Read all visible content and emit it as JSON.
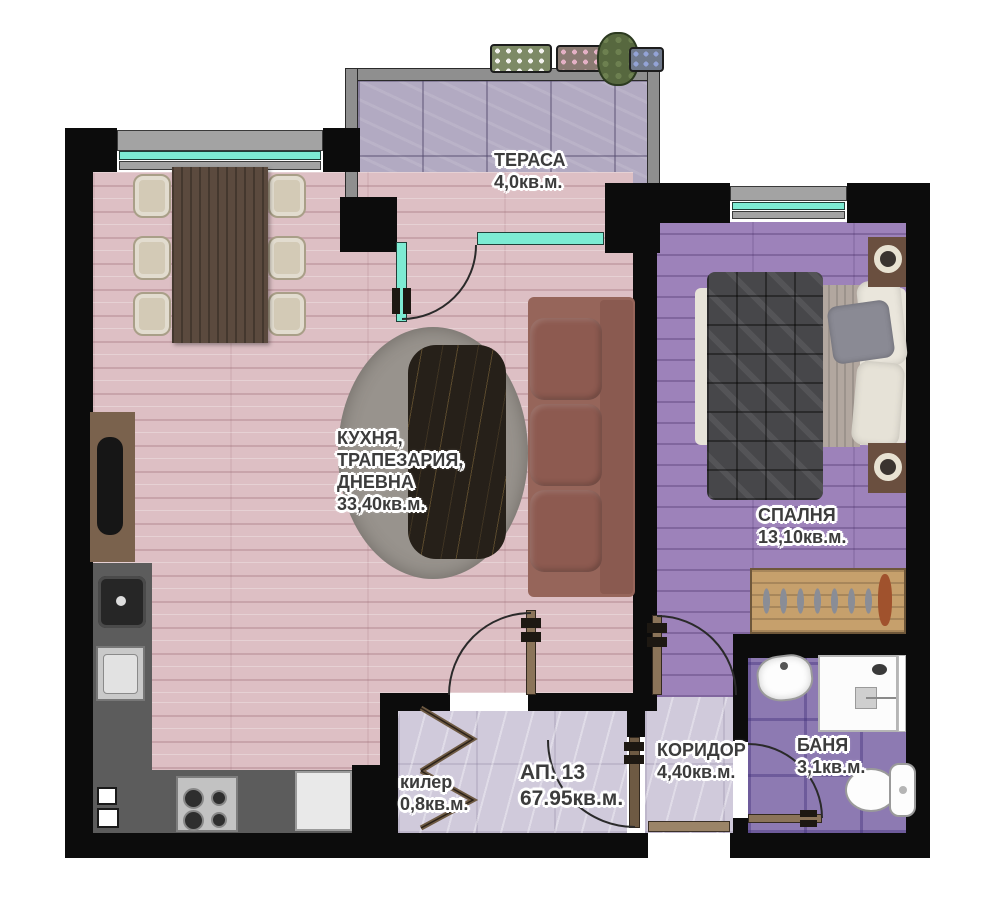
{
  "apartment": {
    "number": "АП. 13",
    "total_area": "67.95кв.м."
  },
  "rooms": {
    "terrace": {
      "name": "ТЕРАСА",
      "area": "4,0кв.м."
    },
    "living": {
      "name_lines": [
        "КУХНЯ,",
        "ТРАПЕЗАРИЯ,",
        "ДНЕВНА"
      ],
      "area": "33,40кв.м."
    },
    "bedroom": {
      "name": "СПАЛНЯ",
      "area": "13,10кв.м."
    },
    "closet": {
      "name": "килер",
      "area": "0,8кв.м."
    },
    "corridor": {
      "name": "КОРИДОР",
      "area": "4,40кв.м."
    },
    "bathroom": {
      "name": "БАНЯ",
      "area": "3,1кв.м."
    }
  },
  "colors": {
    "wall": "#0c0c0c",
    "glass": "#7debd3",
    "window_frame": "#9b9b9b",
    "living_floor": "#ddbfc4",
    "bedroom_floor": "#9d82ba",
    "terrace_floor": "#b2aac2",
    "bathroom_tile": "#8d7ab2",
    "hall_tile": "#d0cadb",
    "kitchen_counter": "#5c5c5c",
    "label_text": "#3c3c3c"
  },
  "furniture": {
    "living": [
      "dining-table",
      "dining-chairs",
      "rug",
      "coffee-table",
      "sofa",
      "tv-console",
      "kitchen-counter",
      "kitchen-sink",
      "stove",
      "fridge"
    ],
    "bedroom": [
      "double-bed",
      "nightstands",
      "wardrobe-rack"
    ],
    "bathroom": [
      "washbasin",
      "shower",
      "toilet"
    ],
    "terrace": [
      "flower-boxes"
    ]
  }
}
